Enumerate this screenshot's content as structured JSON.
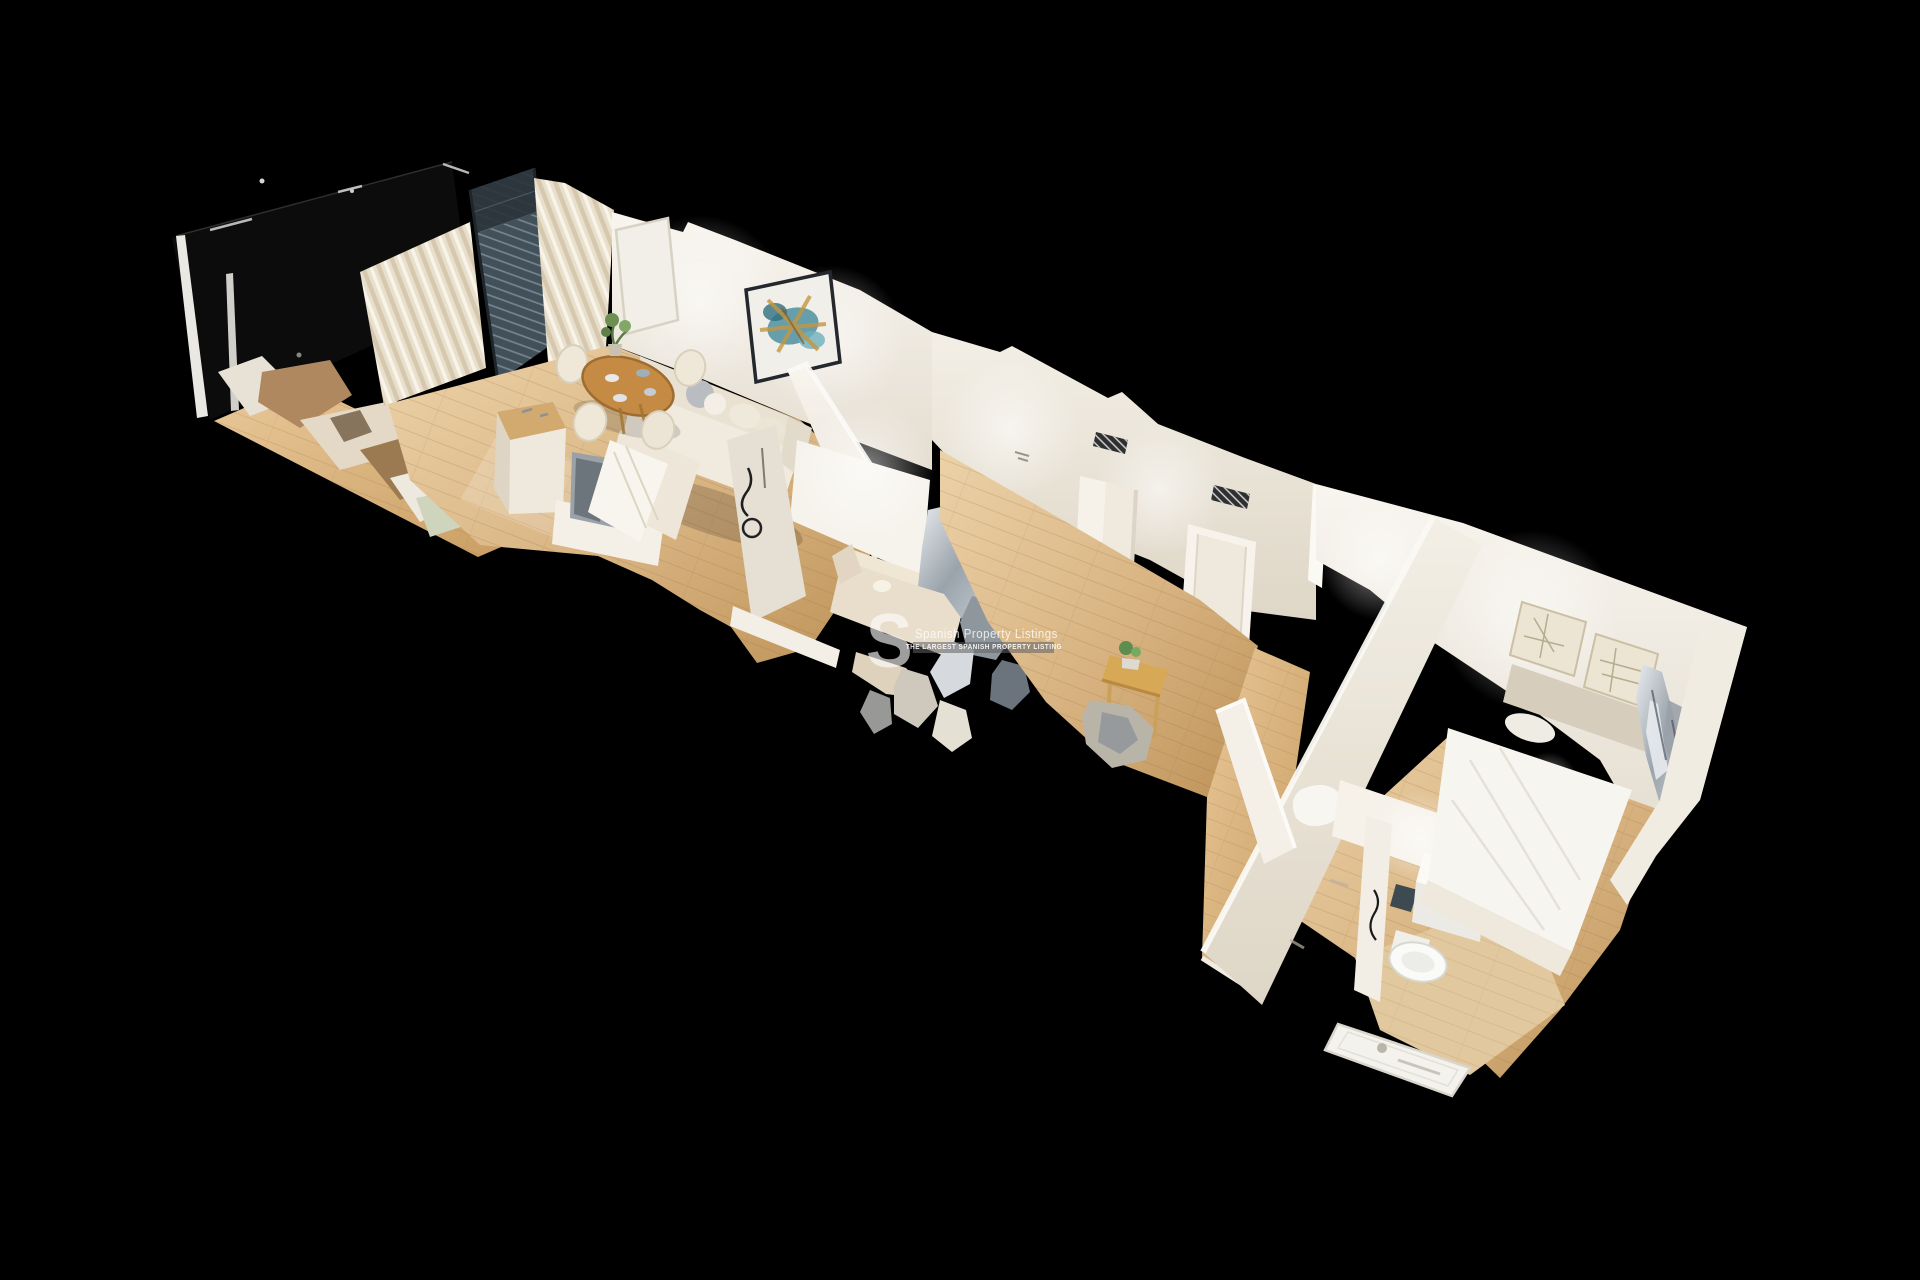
{
  "view": {
    "kind": "3d-dollhouse-scan-render",
    "subject": "apartment cutaway model"
  },
  "watermark": {
    "logo_letter": "S",
    "brand": "Spanish Property Listings",
    "tagline": "THE LARGEST SPANISH PROPERTY LISTING",
    "text_color": "#ffffff",
    "bar_color": "rgba(96,96,96,0.55)"
  },
  "palette": {
    "background": "#000000",
    "wall_light": "#f7f4ee",
    "wall_shadow": "#ddd5c7",
    "floor_wood": "#d9b587",
    "floor_wood_dark": "#b98d54",
    "curtain": "#e8dfcc",
    "window_dark": "#42505a",
    "painting_teal": "#4f8fa0",
    "painting_gold": "#c49742",
    "glitch_silver": "#b9c0c6",
    "sofa_cream": "#efe9dc"
  }
}
